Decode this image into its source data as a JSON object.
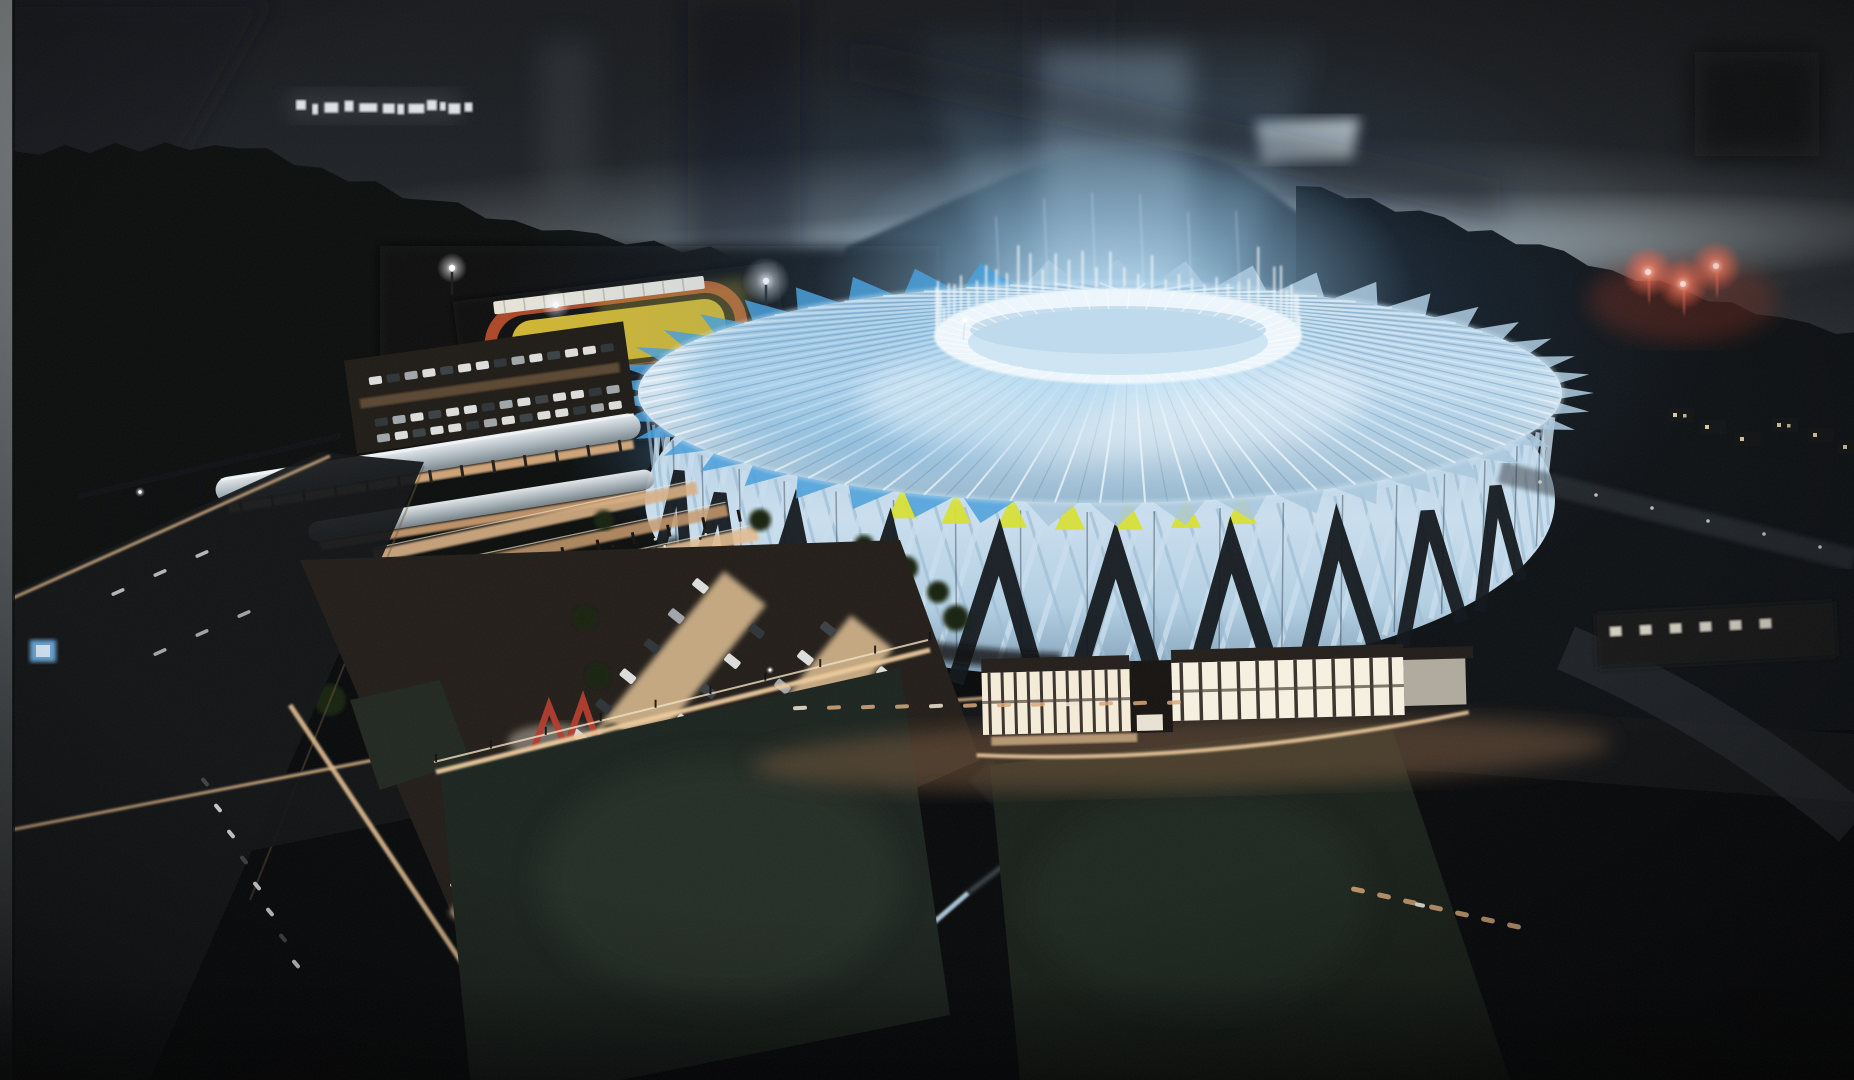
{
  "scene": {
    "type": "night-aerial-architectural-rendering",
    "subject": "illuminated woven-lattice arena with vertical light beam",
    "surroundings": [
      "forested hills",
      "athletics track with yellow infield",
      "parking lots with cars",
      "plaza promenades with crowds",
      "access roads",
      "white canopy pavilions"
    ],
    "effects": {
      "red_flares_on_hill": 3,
      "street_lamp_flares": 2,
      "horizon_glow_band": true,
      "roof_light_beam": true,
      "distant_window_strip": true
    },
    "counts": {
      "yellow_roof_triangles": 7,
      "dark_facade_chevrons": 10,
      "roof_ribs": 64
    }
  },
  "palette": {
    "bg": "#07080a",
    "border_top": "#8d9193",
    "border_mid": "#54585a",
    "border_bottom": "#1f2224",
    "sky_top": "#17191c",
    "sky_upper": "#22262a",
    "sky_lower": "#565f63",
    "band_bright": "#cfd8da",
    "band_mid": "#aab4b7",
    "mountain": "#191d20",
    "hill_left": "#0a0d0b",
    "hill_right": "#0d1013",
    "forest": "#0b0e0b",
    "distant_windows": "#e9edef",
    "glow_blue": "#7fc0ee",
    "glow_blue_bright": "#d6edfb",
    "beam_blue": "#a2d2f2",
    "roof_light": "#d7e8f4",
    "roof_mid": "#aac7dd",
    "roof_dark": "#7fa3bd",
    "rib_light": "#eff7fc",
    "rib_shadow": "#7795ab",
    "skirt_light": "#cadfef",
    "skirt_mid": "#9cbcd4",
    "lattice_dark": "#10151a",
    "petal_blue": "#479fdb",
    "oculus_white": "#edf7fd",
    "oculus_inner": "#cfe6f5",
    "accent_yellow": "#d8e033",
    "pavilion_window": "#f5ecd9",
    "pavilion_frame": "#39312a",
    "pavilion_fascia": "#221d19",
    "pavilion_sill": "#c9a87e",
    "plaza_warm": "#d7aa79",
    "plaza_bright": "#ecca9b",
    "plaza_dim": "#8a6a4d",
    "canopy_white": "#e2e8ec",
    "canopy_shadow": "#8f9ba2",
    "road_dark": "#121416",
    "curb_warm": "#d8b183",
    "lane_mark": "#cfd4d6",
    "lawn": "#1b231e",
    "lawn_light": "#2a342c",
    "car_white": "#e8e9e7",
    "car_gray": "#a7adb1",
    "car_dark": "#2f353a",
    "tree_green": "#13200f",
    "sculpture_red": "#b23b2c",
    "track_yellow": "#d2b62d",
    "track_orange": "#bd4e28",
    "stands_white": "#e8e4d9",
    "hedge": "#0b100b",
    "flare_red": "#ff6f55",
    "flare_core": "#ffd8cd",
    "lamp_white": "#ffffff",
    "sign_blue": "#6fb2e8",
    "path_blue": "#bad7e9",
    "window_dot": "#ecdcab"
  }
}
